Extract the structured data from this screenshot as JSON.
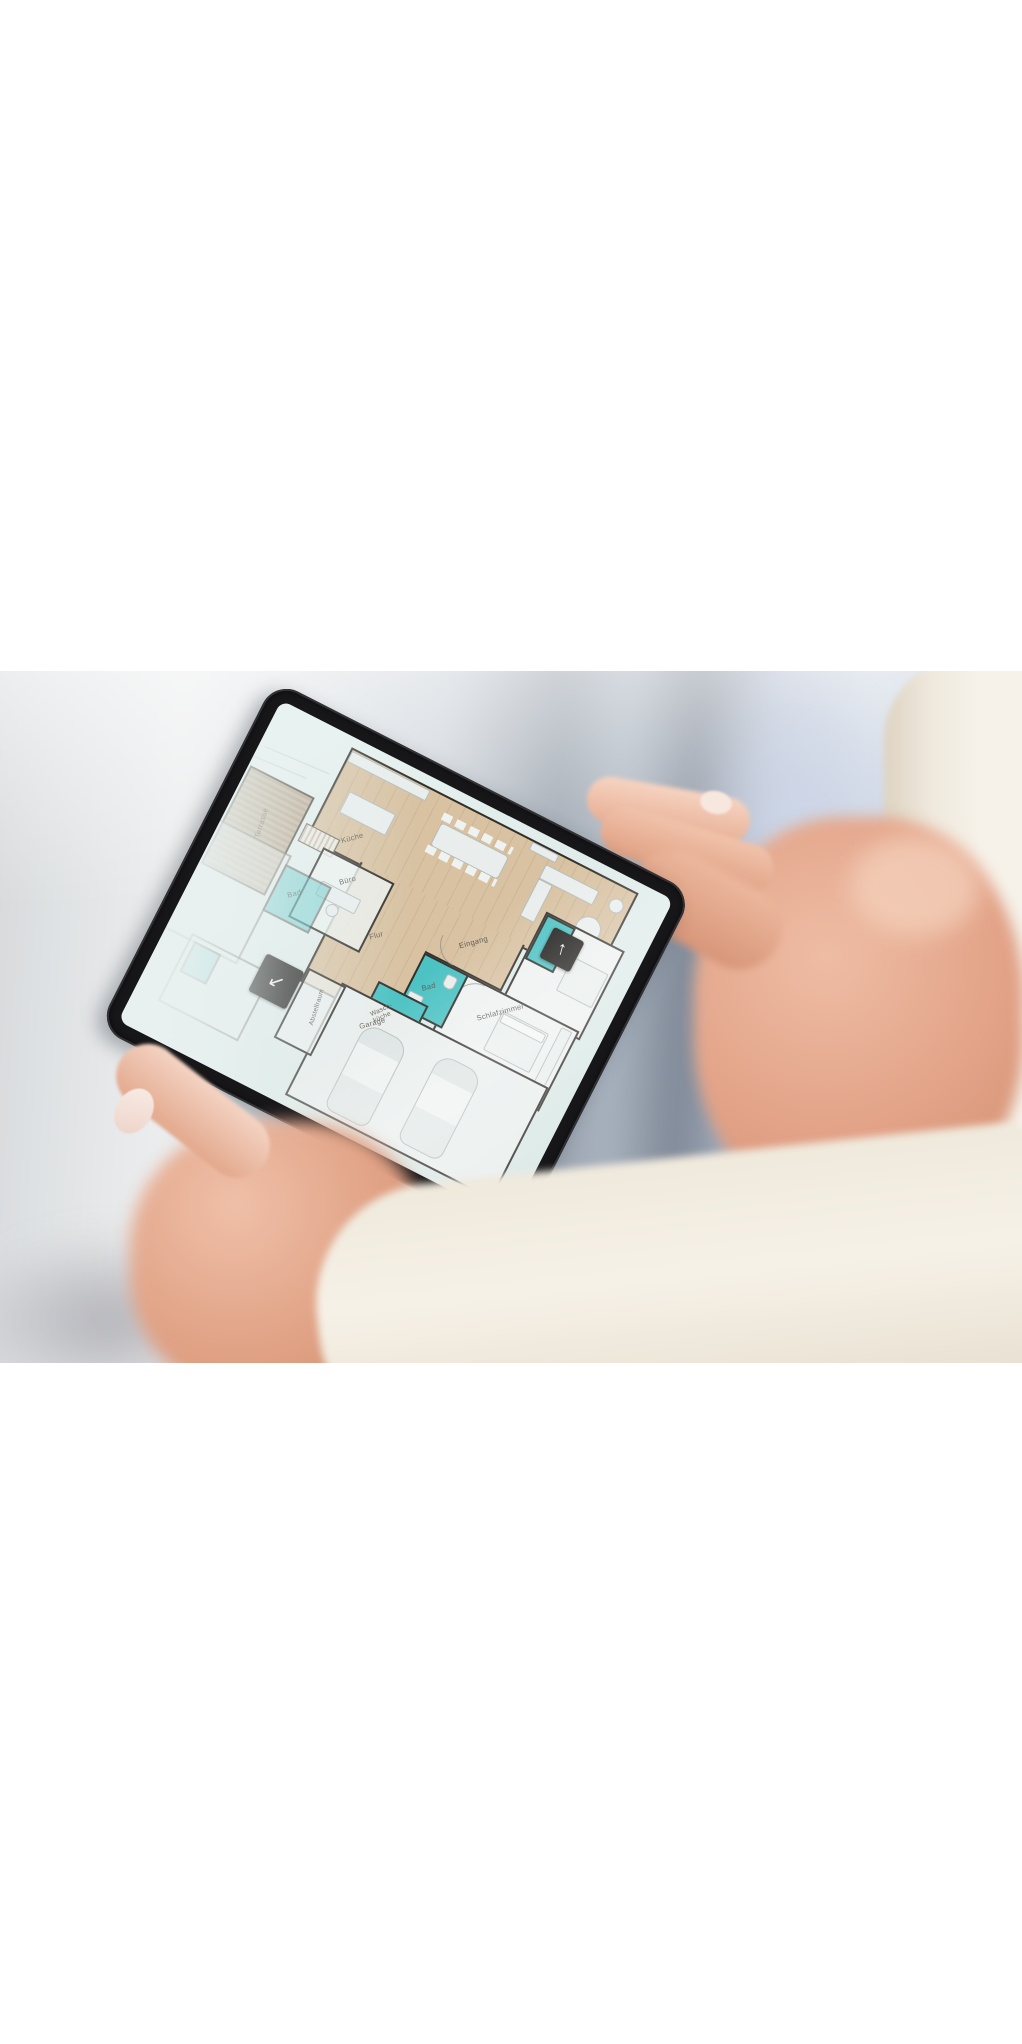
{
  "floor_plan": {
    "rooms": [
      {
        "id": "kueche",
        "label": "Küche"
      },
      {
        "id": "terrasse",
        "label": "Terrasse"
      },
      {
        "id": "buero",
        "label": "Büro"
      },
      {
        "id": "flur",
        "label": "Flur"
      },
      {
        "id": "eingang",
        "label": "Eingang"
      },
      {
        "id": "schlafzimmer",
        "label": "Schlafzimmer"
      },
      {
        "id": "bad",
        "label": "Bad"
      },
      {
        "id": "waschkueche",
        "label": "Wasch-küche"
      },
      {
        "id": "bad-links",
        "label": "Bad"
      },
      {
        "id": "abstellraum",
        "label": "Abstellraum"
      },
      {
        "id": "garage",
        "label": "Garage"
      }
    ],
    "buttons": [
      {
        "id": "level-up",
        "glyph": "↑"
      },
      {
        "id": "level-down",
        "glyph": "↙"
      }
    ],
    "colors": {
      "wet_room_teal": "#4cc2c3",
      "wood_floor": "#d8c2a2",
      "terrace_deck": "#b3a28a",
      "wall": "#33302b",
      "screen_mint": "#e2edeb",
      "bezel_black": "#17171a",
      "button_black": "#1e1d1b"
    }
  }
}
